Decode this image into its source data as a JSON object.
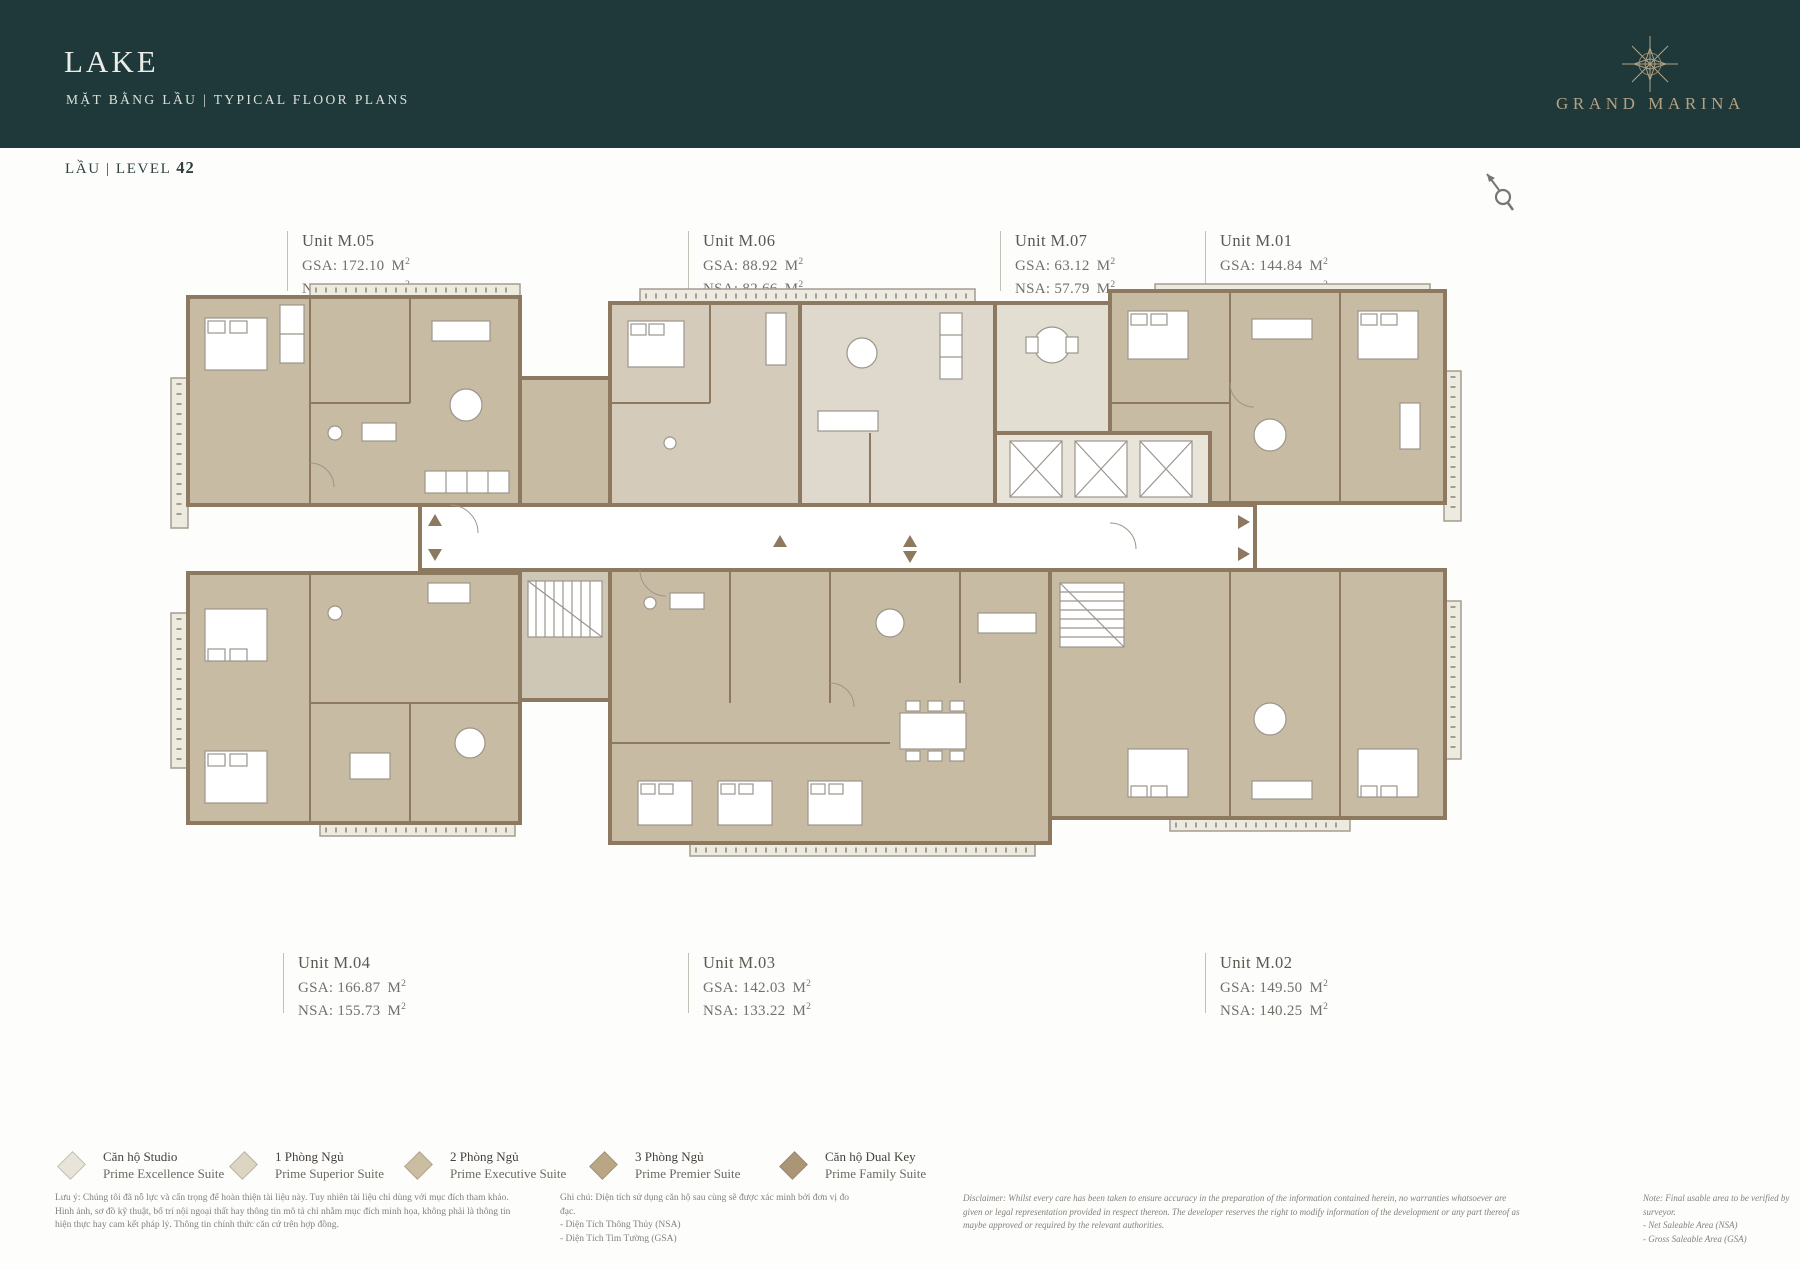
{
  "palette": {
    "header_bg": "#1f3839",
    "brand_gold": "#b3a284",
    "wall_brown": "#8c7960",
    "floor_main": "#c8bba3",
    "floor_light": "#d4cbba",
    "floor_lightest": "#ded9cc",
    "balcony": "#edeadf",
    "page_bg": "#fdfdfc"
  },
  "header": {
    "title": "LAKE",
    "subtitle": "MẶT BẰNG LẦU  |  TYPICAL FLOOR PLANS",
    "brand": "GRAND MARINA"
  },
  "level": {
    "prefix": "LẦU | LEVEL",
    "value": "42"
  },
  "units": {
    "area_unit": "M",
    "area_exp": "2",
    "top": [
      {
        "name": "Unit M.05",
        "gsa": "GSA: 172.10",
        "nsa": "NSA: 159.69"
      },
      {
        "name": "Unit M.06",
        "gsa": "GSA: 88.92",
        "nsa": "NSA: 82.66"
      },
      {
        "name": "Unit M.07",
        "gsa": "GSA: 63.12",
        "nsa": "NSA: 57.79"
      },
      {
        "name": "Unit M.01",
        "gsa": "GSA: 144.84",
        "nsa": "NSA: 135.54"
      }
    ],
    "bottom": [
      {
        "name": "Unit M.04",
        "gsa": "GSA: 166.87",
        "nsa": "NSA: 155.73"
      },
      {
        "name": "Unit M.03",
        "gsa": "GSA: 142.03",
        "nsa": "NSA: 133.22"
      },
      {
        "name": "Unit M.02",
        "gsa": "GSA: 149.50",
        "nsa": "NSA: 140.25"
      }
    ]
  },
  "legend": [
    {
      "vi": "Căn hộ Studio",
      "en": "Prime Excellence Suite",
      "color": "#e9e4d9"
    },
    {
      "vi": "1 Phòng Ngủ",
      "en": "Prime Superior Suite",
      "color": "#ddd4c2"
    },
    {
      "vi": "2 Phòng Ngủ",
      "en": "Prime Executive Suite",
      "color": "#cbbda2"
    },
    {
      "vi": "3 Phòng Ngủ",
      "en": "Prime Premier Suite",
      "color": "#b9a684"
    },
    {
      "vi": "Căn hộ Dual Key",
      "en": "Prime Family Suite",
      "color": "#ab9577"
    }
  ],
  "footnotes": {
    "luu_y": "Lưu ý: Chúng tôi đã nỗ lực và cẩn trọng để hoàn thiện tài liệu này. Tuy nhiên tài liệu chỉ dùng với mục đích tham khảo. Hình ảnh, sơ đồ kỹ thuật, bố trí nội ngoại thất hay thông tin mô tả chỉ nhằm mục đích minh họa, không phải là thông tin hiện thực hay cam kết pháp lý. Thông tin chính thức căn cứ trên hợp đồng.",
    "ghi_chu": {
      "title": "Ghi chú: Diện tích sử dụng căn hộ sau cùng sẽ được xác minh bởi đơn vị đo đạc.",
      "items": [
        "- Diện Tích Thông Thủy (NSA)",
        "- Diện Tích Tim Tường (GSA)"
      ]
    },
    "disclaimer": "Disclaimer: Whilst every care has been taken to ensure accuracy in the preparation of the information contained herein, no warranties whatsoever are given or legal representation provided in respect thereon. The developer reserves the right to modify information of the development or any part thereof as maybe approved or required by the relevant authorities.",
    "note": {
      "title": "Note: Final usable area to be verified by surveyor.",
      "items": [
        "- Net Saleable Area (NSA)",
        "- Gross Saleable Area (GSA)"
      ]
    }
  }
}
